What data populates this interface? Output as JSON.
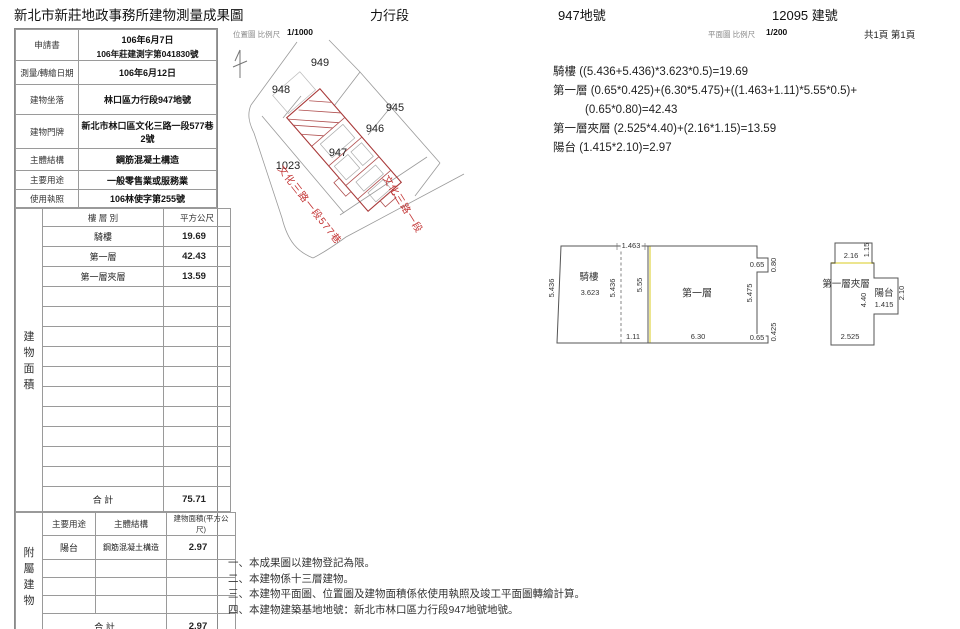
{
  "header": {
    "office_title": "新北市新莊地政事務所建物測量成果圖",
    "section": "力行段",
    "land_no": "947地號",
    "building_no": "12095 建號"
  },
  "map_header": {
    "title": "位置圖 比例尺",
    "scale": "1/1000"
  },
  "plan_header": {
    "title": "平面圖 比例尺",
    "scale": "1/200",
    "page": "共1頁 第1頁"
  },
  "info_table": {
    "rows": [
      {
        "label": "申請書",
        "value": "106年6月7日",
        "value2": "106年莊建測字第041830號"
      },
      {
        "label": "測量/轉繪日期",
        "value": "106年6月12日"
      },
      {
        "label": "建物坐落",
        "value": "林口區力行段947地號"
      },
      {
        "label": "建物門牌",
        "value": "新北市林口區文化三路一段577巷2號"
      },
      {
        "label": "主體結構",
        "value": "鋼筋混凝土構造"
      },
      {
        "label": "主要用途",
        "value": "一般零售業或服務業"
      },
      {
        "label": "使用執照",
        "value": "106林使字第255號"
      }
    ]
  },
  "area_table": {
    "side_chars": [
      "建",
      "物",
      "面",
      "積"
    ],
    "floor_col": "樓 層 別",
    "unit_col": "平方公尺",
    "rows": [
      {
        "floor": "騎樓",
        "area": "19.69"
      },
      {
        "floor": "第一層",
        "area": "42.43"
      },
      {
        "floor": "第一層夾層",
        "area": "13.59"
      }
    ],
    "total_label": "合  計",
    "total": "75.71"
  },
  "annex_table": {
    "side_chars": [
      "附",
      "屬",
      "建",
      "物"
    ],
    "use_col": "主要用途",
    "structure_col": "主體結構",
    "area_col": "建物面積(平方公尺)",
    "rows": [
      {
        "use": "陽台",
        "structure": "鋼筋混凝土構造",
        "area": "2.97"
      }
    ],
    "total_label": "合  計",
    "total": "2.97"
  },
  "location_map": {
    "parcels": {
      "p949": "949",
      "p948": "948",
      "p945": "945",
      "p946": "946",
      "p947": "947",
      "p1023": "1023"
    },
    "roads": {
      "lane": "文化三路一段577巷",
      "road": "文化三路一段"
    }
  },
  "floor_plan": {
    "main": {
      "left_h": "5.436",
      "arcade_label": "騎樓",
      "arcade_w": "3.623",
      "dash_h": "5.436",
      "mid_h": "5.55",
      "top_w": "1.463",
      "bottom_l": "1.11",
      "room_label": "第一層",
      "bottom_w": "6.30",
      "right_h": "5.475",
      "notch_w": "0.65",
      "notch_h": "0.80",
      "step_w": "0.65",
      "step_h": "0.425"
    },
    "mezz": {
      "room_label": "第一層夾層",
      "top_w": "2.16",
      "top_h": "1.15",
      "height": "4.40",
      "balcony_label": "陽台",
      "balcony_w": "1.415",
      "balcony_h": "2.10",
      "bottom_w": "2.525"
    }
  },
  "calculations": {
    "line1": "騎樓 ((5.436+5.436)*3.623*0.5)=19.69",
    "line2": "第一層 (0.65*0.425)+(6.30*5.475)+((1.463+1.11)*5.55*0.5)+",
    "line3": "(0.65*0.80)=42.43",
    "line4": "第一層夾層 (2.525*4.40)+(2.16*1.15)=13.59",
    "line5": "陽台 (1.415*2.10)=2.97"
  },
  "notes": {
    "n1": "一、本成果圖以建物登記為限。",
    "n2": "二、本建物係十三層建物。",
    "n3": "三、本建物平面圖、位置圖及建物面積係依使用執照及竣工平面圖轉繪計算。",
    "n4": "四、本建物建築基地地號：新北市林口區力行段947地號地號。"
  }
}
